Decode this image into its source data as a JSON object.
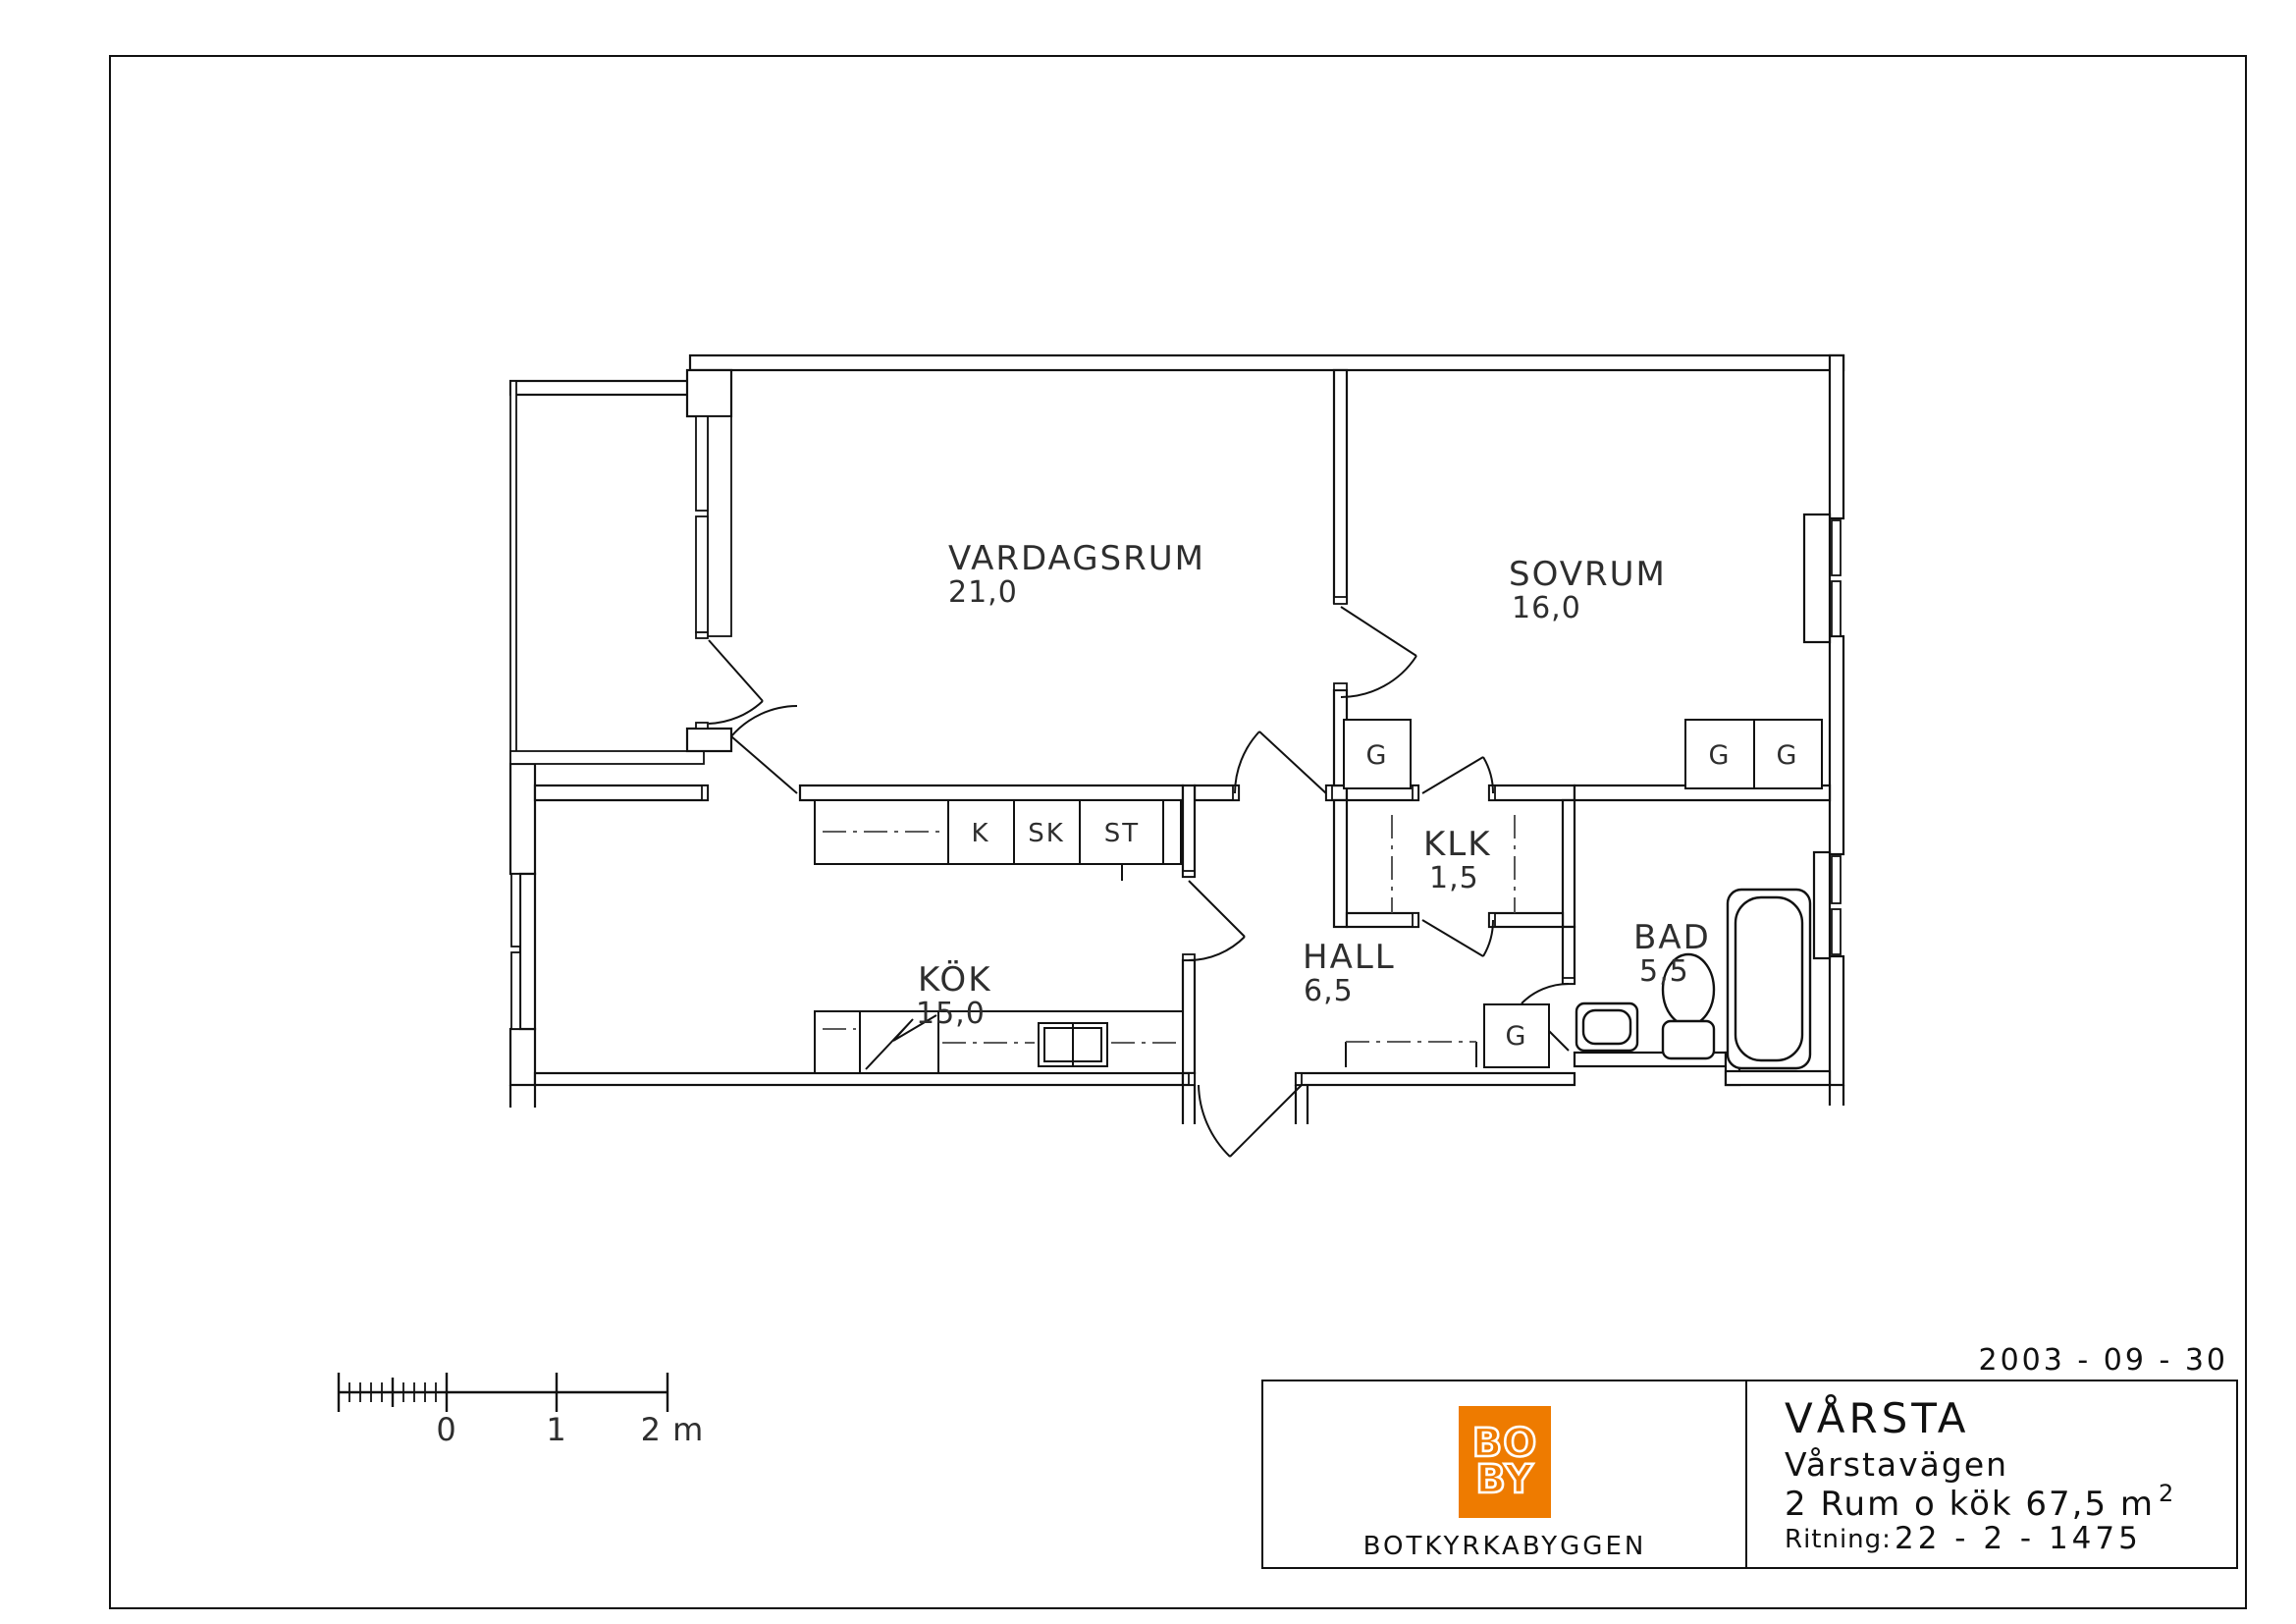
{
  "date": "2003 - 09 - 30",
  "plan": {
    "rooms": [
      {
        "label": "VARDAGSRUM",
        "area": "21,0"
      },
      {
        "label": "SOVRUM",
        "area": "16,0"
      },
      {
        "label": "KÖK",
        "area": "15,0"
      },
      {
        "label": "HALL",
        "area": "6,5"
      },
      {
        "label": "KLK",
        "area": "1,5"
      },
      {
        "label": "BAD",
        "area": "5,5"
      }
    ],
    "closets": [
      {
        "label": "G"
      },
      {
        "label": "G"
      },
      {
        "label": "G"
      },
      {
        "label": "G"
      }
    ],
    "cabinets": [
      {
        "label": "K"
      },
      {
        "label": "SK"
      },
      {
        "label": "ST"
      }
    ]
  },
  "scalebar": {
    "tick0": "0",
    "tick1": "1",
    "tick2": "2 m"
  },
  "titleblock": {
    "logo_line1": "BO",
    "logo_line2": "BY",
    "company": "BOTKYRKABYGGEN",
    "area_name": "VÅRSTA",
    "street": "Vårstavägen",
    "apartment": "2 Rum o kök 67,5 m",
    "apartment_sup": "2",
    "drawing_label": "Ritning:",
    "drawing_number": "22 - 2 - 1475"
  },
  "colors": {
    "accent": "#ee7b00",
    "line": "#111111"
  }
}
